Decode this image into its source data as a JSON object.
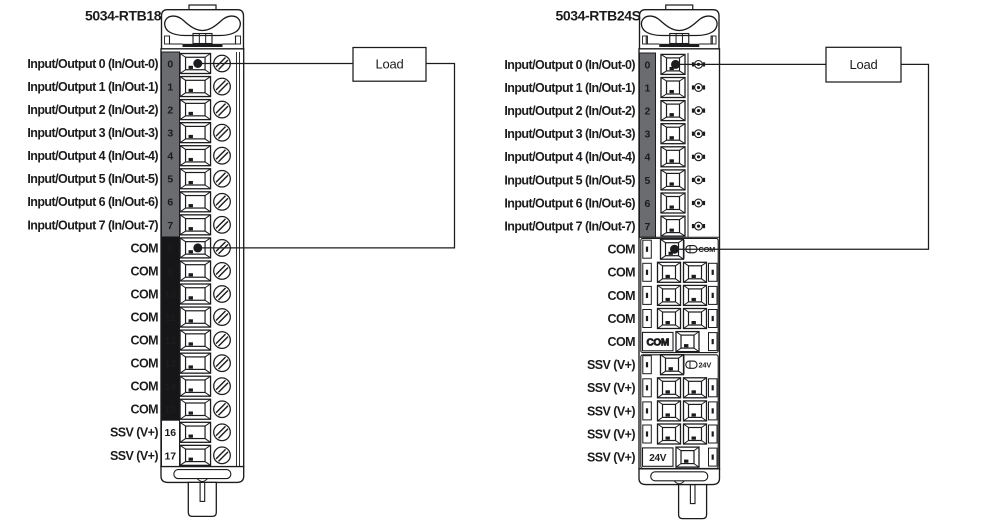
{
  "colors": {
    "line": "#1c1c1e",
    "io_cell": "#6a6c6f",
    "com_cell": "#161619",
    "background": "#ffffff"
  },
  "left_diagram": {
    "title": "5034-RTB18",
    "load_label": "Load",
    "terminals": [
      {
        "no": "0",
        "label": "Input/Output 0 (In/Out-0)",
        "group": "io",
        "wired": true
      },
      {
        "no": "1",
        "label": "Input/Output 1 (In/Out-1)",
        "group": "io"
      },
      {
        "no": "2",
        "label": "Input/Output 2 (In/Out-2)",
        "group": "io"
      },
      {
        "no": "3",
        "label": "Input/Output 3 (In/Out-3)",
        "group": "io"
      },
      {
        "no": "4",
        "label": "Input/Output 4 (In/Out-4)",
        "group": "io"
      },
      {
        "no": "5",
        "label": "Input/Output 5 (In/Out-5)",
        "group": "io"
      },
      {
        "no": "6",
        "label": "Input/Output 6 (In/Out-6)",
        "group": "io"
      },
      {
        "no": "7",
        "label": "Input/Output 7 (In/Out-7)",
        "group": "io"
      },
      {
        "no": "8",
        "label": "COM",
        "group": "com",
        "wired": true
      },
      {
        "no": "9",
        "label": "COM",
        "group": "com"
      },
      {
        "no": "10",
        "label": "COM",
        "group": "com"
      },
      {
        "no": "11",
        "label": "COM",
        "group": "com"
      },
      {
        "no": "12",
        "label": "COM",
        "group": "com"
      },
      {
        "no": "13",
        "label": "COM",
        "group": "com"
      },
      {
        "no": "14",
        "label": "COM",
        "group": "com"
      },
      {
        "no": "15",
        "label": "COM",
        "group": "com"
      },
      {
        "no": "16",
        "label": "SSV (V+)",
        "group": "ssv"
      },
      {
        "no": "17",
        "label": "SSV (V+)",
        "group": "ssv"
      }
    ]
  },
  "right_diagram": {
    "title": "5034-RTB24S",
    "load_label": "Load",
    "terminals": [
      {
        "no": "0",
        "label": "Input/Output 0 (In/Out-0)",
        "variant": "io",
        "wired": true
      },
      {
        "no": "1",
        "label": "Input/Output 1 (In/Out-1)",
        "variant": "io"
      },
      {
        "no": "2",
        "label": "Input/Output 2 (In/Out-2)",
        "variant": "io"
      },
      {
        "no": "3",
        "label": "Input/Output 3 (In/Out-3)",
        "variant": "io"
      },
      {
        "no": "4",
        "label": "Input/Output 4 (In/Out-4)",
        "variant": "io"
      },
      {
        "no": "5",
        "label": "Input/Output 5 (In/Out-5)",
        "variant": "io"
      },
      {
        "no": "6",
        "label": "Input/Output 6 (In/Out-6)",
        "variant": "io"
      },
      {
        "no": "7",
        "label": "Input/Output 7 (In/Out-7)",
        "variant": "io"
      },
      {
        "label": "COM",
        "variant": "bus-start",
        "bus_label": "COM",
        "wired": true
      },
      {
        "label": "COM",
        "variant": "pair"
      },
      {
        "label": "COM",
        "variant": "pair"
      },
      {
        "label": "COM",
        "variant": "pair"
      },
      {
        "label": "COM",
        "variant": "bus-end",
        "bus_label": "COM",
        "bus_style": "outline"
      },
      {
        "label": "SSV (V+)",
        "variant": "bus-start",
        "bus_label": "24V"
      },
      {
        "label": "SSV (V+)",
        "variant": "pair"
      },
      {
        "label": "SSV (V+)",
        "variant": "pair"
      },
      {
        "label": "SSV (V+)",
        "variant": "pair"
      },
      {
        "label": "SSV (V+)",
        "variant": "bus-end",
        "bus_label": "24V",
        "bus_style": "solid"
      }
    ]
  }
}
